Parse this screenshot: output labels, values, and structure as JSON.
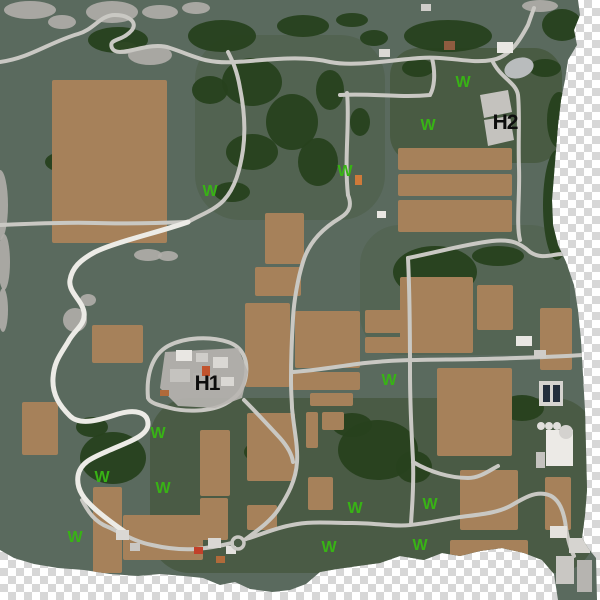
{
  "title": "farm-map-preview",
  "colors": {
    "checker_light": "#ffffff",
    "checker_dark": "#d7d7d7",
    "terrain": "#5a6a5e",
    "terrain_dark": "#46583e",
    "terrain_mid": "#4e5f4a",
    "forest": "#27411d",
    "field": "#a6815a",
    "road": "#c9c8c3",
    "road_white": "#ecebe6",
    "rock": "#b0aeaa",
    "water": "#b9bcbd",
    "pad": "#c4c2be",
    "platform": "#b8b5b1",
    "marker_green": "#38b315",
    "marker_black": "#0d0d0d"
  },
  "map": {
    "outline": "M0,0 L578,0 L580,15 L574,30 L577,45 L568,60 L565,80 L561,100 L558,125 L556,150 L554,175 L552,200 L553,225 L558,245 L566,262 L574,285 L578,310 L581,340 L583,375 L585,410 L586,450 L587,490 L585,515 L582,538 L588,548 L596,558 L597,600 L558,600 L554,574 L542,560 L524,553 L502,548 L480,551 L460,556 L442,553 L424,560 L400,556 L380,563 L358,566 L337,569 L320,572 L306,584 L290,590 L272,592 L250,589 L235,582 L220,585 L203,578 L184,576 L160,574 L138,576 L110,574 L84,570 L58,568 L34,564 L14,558 L0,550 Z",
    "regions": [
      {
        "x": 390,
        "y": 48,
        "w": 172,
        "h": 115,
        "rx": 28,
        "fill": "terrain_dark",
        "opacity": 0.85
      },
      {
        "x": 150,
        "y": 398,
        "w": 445,
        "h": 175,
        "rx": 40,
        "fill": "terrain_dark",
        "opacity": 0.8
      },
      {
        "x": 195,
        "y": 35,
        "w": 190,
        "h": 185,
        "rx": 45,
        "fill": "terrain_mid",
        "opacity": 0.65
      },
      {
        "x": 360,
        "y": 225,
        "w": 210,
        "h": 130,
        "rx": 40,
        "fill": "terrain_mid",
        "opacity": 0.5
      }
    ],
    "rocks": [
      [
        30,
        10,
        26,
        9
      ],
      [
        112,
        12,
        26,
        11
      ],
      [
        62,
        22,
        14,
        7
      ],
      [
        160,
        12,
        18,
        7
      ],
      [
        196,
        8,
        14,
        6
      ],
      [
        540,
        6,
        18,
        6
      ],
      [
        0,
        205,
        8,
        35
      ],
      [
        4,
        262,
        6,
        28
      ],
      [
        3,
        310,
        5,
        22
      ],
      [
        148,
        255,
        14,
        6
      ],
      [
        168,
        256,
        10,
        5
      ],
      [
        75,
        320,
        12,
        12
      ],
      [
        88,
        300,
        8,
        6
      ],
      [
        150,
        55,
        22,
        10
      ],
      [
        125,
        48,
        12,
        6
      ]
    ],
    "forests": [
      [
        118,
        40,
        30,
        13
      ],
      [
        222,
        36,
        34,
        16
      ],
      [
        303,
        26,
        26,
        11
      ],
      [
        352,
        20,
        16,
        7
      ],
      [
        448,
        36,
        44,
        16
      ],
      [
        562,
        25,
        20,
        16
      ],
      [
        95,
        150,
        36,
        20
      ],
      [
        63,
        162,
        18,
        10
      ],
      [
        210,
        90,
        18,
        14
      ],
      [
        252,
        82,
        30,
        24
      ],
      [
        292,
        122,
        26,
        28
      ],
      [
        252,
        152,
        26,
        18
      ],
      [
        318,
        162,
        20,
        24
      ],
      [
        232,
        192,
        18,
        10
      ],
      [
        374,
        38,
        14,
        8
      ],
      [
        418,
        68,
        16,
        9
      ],
      [
        330,
        90,
        14,
        20
      ],
      [
        360,
        122,
        10,
        14
      ],
      [
        150,
        178,
        16,
        8
      ],
      [
        95,
        147,
        12,
        34
      ],
      [
        435,
        272,
        42,
        26
      ],
      [
        498,
        256,
        26,
        10
      ],
      [
        557,
        205,
        14,
        55
      ],
      [
        559,
        120,
        12,
        28
      ],
      [
        545,
        68,
        16,
        9
      ],
      [
        378,
        450,
        40,
        30
      ],
      [
        352,
        425,
        20,
        12
      ],
      [
        414,
        467,
        18,
        16
      ],
      [
        270,
        452,
        26,
        13
      ],
      [
        113,
        458,
        33,
        26
      ],
      [
        92,
        427,
        16,
        10
      ],
      [
        522,
        408,
        22,
        13
      ],
      [
        474,
        561,
        18,
        7
      ]
    ],
    "fields": [
      [
        52,
        80,
        115,
        163
      ],
      [
        92,
        325,
        51,
        38
      ],
      [
        22,
        402,
        36,
        53
      ],
      [
        93,
        487,
        29,
        86
      ],
      [
        123,
        515,
        80,
        45
      ],
      [
        200,
        430,
        30,
        66
      ],
      [
        200,
        498,
        28,
        42
      ],
      [
        247,
        505,
        30,
        25
      ],
      [
        265,
        213,
        39,
        51
      ],
      [
        255,
        267,
        46,
        29
      ],
      [
        245,
        303,
        45,
        84
      ],
      [
        295,
        311,
        65,
        57
      ],
      [
        292,
        372,
        68,
        18
      ],
      [
        310,
        393,
        43,
        13
      ],
      [
        365,
        310,
        70,
        23
      ],
      [
        365,
        337,
        70,
        16
      ],
      [
        398,
        148,
        114,
        22
      ],
      [
        398,
        174,
        114,
        22
      ],
      [
        398,
        200,
        114,
        32
      ],
      [
        400,
        277,
        73,
        76
      ],
      [
        477,
        285,
        36,
        45
      ],
      [
        540,
        308,
        32,
        62
      ],
      [
        437,
        368,
        75,
        88
      ],
      [
        460,
        470,
        58,
        60
      ],
      [
        545,
        477,
        26,
        53
      ],
      [
        450,
        540,
        78,
        24
      ],
      [
        247,
        413,
        48,
        68
      ],
      [
        306,
        412,
        12,
        36
      ],
      [
        322,
        412,
        22,
        18
      ],
      [
        308,
        477,
        25,
        33
      ]
    ],
    "roads": [
      "M0,62 C30,58 50,42 78,34 C95,29 100,15 115,15 C128,15 138,22 132,30 C122,42 108,38 112,48 C118,60 148,40 170,48 C195,56 205,64 235,62 C270,60 300,55 330,62 C355,67 390,60 420,58 C450,56 470,64 492,60 C510,57 520,40 528,25 L534,8",
      "M347,93 C350,120 344,160 348,195",
      "M432,58 C436,75 434,88 430,95 C400,98 370,93 340,95",
      "M492,60 C500,78 516,82 518,95 C520,115 518,140 519,168 C520,195 516,225 520,240",
      "M408,258 C438,252 466,244 492,241 C512,239 520,243 530,252 C542,260 552,254 562,254",
      "M348,195 C352,205 350,212 340,218 C320,230 308,245 303,262 C298,278 294,300 293,318 C292,335 291,360 291,380 C291,395 292,402 292,408 C294,430 298,445 297,462 C296,480 288,495 278,510 C270,522 255,532 246,539",
      "M293,372 C320,370 340,366 365,363 C400,359 440,360 480,359 C520,358 555,357 583,355",
      "M408,258 C410,300 410,340 410,372 C410,410 412,440 413,460 C414,490 412,505 411,524",
      "M413,462 C430,472 450,478 468,478 C480,478 490,470 498,466",
      "M246,539 C260,535 275,528 292,525 C310,521 330,523 352,523 C375,523 395,527 410,525 C430,523 450,518 468,516 C485,514 500,512 512,505 C524,498 534,492 545,494 C558,496 564,510 566,528 C568,540 570,548 574,556",
      "M232,543 C220,546 208,548 196,549 C180,550 165,548 152,545 C135,542 120,532 108,527 C95,522 88,512 82,500",
      "M148,398 C146,375 152,355 168,346 C185,337 210,336 228,342 C243,347 248,360 246,375 C244,390 236,398 225,404 C210,412 185,412 170,408 C158,405 150,403 148,398 Z",
      "M244,400 C256,412 268,425 280,438 C288,447 292,455 293,462",
      "M188,222 C200,215 215,210 224,200 C235,188 240,170 243,150 C246,128 244,108 240,88 C237,70 232,60 228,52",
      "M0,225 C30,224 60,222 95,223 C130,224 160,223 188,222"
    ],
    "white_roads": [
      "M188,222 C160,232 115,242 95,252 C80,260 72,268 70,280 C68,292 82,300 84,312 C86,325 74,330 68,342 C60,355 54,362 53,378 C52,395 60,406 70,416 C80,426 100,420 118,414 C135,409 148,412 148,424 C148,436 128,442 110,450 C94,457 80,462 78,476 C76,490 85,500 95,509 C105,518 115,525 125,532"
    ],
    "pads": [
      "480,95 508,90 512,112 484,118",
      "484,120 510,116 514,140 488,146"
    ],
    "platform": "165,352 238,348 248,372 242,398 215,408 178,406 160,388",
    "water": {
      "cx": 519,
      "cy": 68,
      "rx": 15,
      "ry": 10,
      "rotate": -18
    },
    "buildings": [
      [
        176,
        350,
        16,
        11,
        "#e9e7e3"
      ],
      [
        196,
        353,
        12,
        9,
        "#cfcdc9"
      ],
      [
        213,
        357,
        15,
        11,
        "#dad8d4"
      ],
      [
        170,
        369,
        20,
        13,
        "#c5c3bf"
      ],
      [
        193,
        373,
        22,
        15,
        "#b2b0ac"
      ],
      [
        221,
        377,
        13,
        9,
        "#dad8d4"
      ],
      [
        202,
        366,
        8,
        10,
        "#c2542e"
      ],
      [
        160,
        390,
        9,
        6,
        "#b06a3a"
      ],
      [
        497,
        42,
        16,
        11,
        "#e9e7e3"
      ],
      [
        379,
        49,
        11,
        8,
        "#dad8d4"
      ],
      [
        444,
        41,
        11,
        9,
        "#8f5c40"
      ],
      [
        516,
        336,
        16,
        10,
        "#e9e7e3"
      ],
      [
        534,
        350,
        12,
        8,
        "#cfcdc9"
      ],
      [
        539,
        381,
        24,
        25,
        "#d6d4d0"
      ],
      [
        543,
        385,
        7,
        17,
        "#232e3c"
      ],
      [
        553,
        385,
        7,
        17,
        "#232e3c"
      ],
      [
        546,
        430,
        27,
        36,
        "#eceae6"
      ],
      [
        536,
        452,
        9,
        16,
        "#c5c3bf"
      ],
      [
        550,
        526,
        17,
        12,
        "#e4e2de"
      ],
      [
        569,
        538,
        21,
        15,
        "#d6d4d0"
      ],
      [
        556,
        556,
        18,
        28,
        "#c9c7c3"
      ],
      [
        577,
        560,
        15,
        32,
        "#b6b4b0"
      ],
      [
        208,
        538,
        13,
        10,
        "#dad8d4"
      ],
      [
        194,
        547,
        9,
        7,
        "#c2402a"
      ],
      [
        216,
        556,
        9,
        7,
        "#b06a3a"
      ],
      [
        226,
        546,
        10,
        8,
        "#e4e2de"
      ],
      [
        116,
        530,
        13,
        10,
        "#dad8d4"
      ],
      [
        130,
        543,
        10,
        8,
        "#c9c7c3"
      ],
      [
        377,
        211,
        9,
        7,
        "#e9e7e3"
      ],
      [
        355,
        175,
        7,
        10,
        "#cf7a3a"
      ],
      [
        421,
        4,
        10,
        7,
        "#cfcdc9"
      ]
    ],
    "silos": [
      [
        541,
        426,
        4,
        "#e0dedb"
      ],
      [
        549,
        426,
        4,
        "#e0dedb"
      ],
      [
        557,
        426,
        4,
        "#e0dedb"
      ],
      [
        566,
        432,
        7,
        "#d4d2cf"
      ]
    ],
    "roundabout": {
      "cx": 238,
      "cy": 543,
      "r": 6
    }
  },
  "labels": {
    "hotspots": [
      {
        "text": "H1",
        "x": 207,
        "y": 390,
        "size": 21
      },
      {
        "text": "H2",
        "x": 505,
        "y": 129,
        "size": 21
      }
    ],
    "w_markers": [
      {
        "text": "W",
        "x": 463,
        "y": 87
      },
      {
        "text": "W",
        "x": 428,
        "y": 130
      },
      {
        "text": "W",
        "x": 345,
        "y": 176
      },
      {
        "text": "W",
        "x": 210,
        "y": 196
      },
      {
        "text": "W",
        "x": 389,
        "y": 385
      },
      {
        "text": "W",
        "x": 158,
        "y": 438
      },
      {
        "text": "W",
        "x": 102,
        "y": 482
      },
      {
        "text": "W",
        "x": 163,
        "y": 493
      },
      {
        "text": "W",
        "x": 75,
        "y": 542
      },
      {
        "text": "W",
        "x": 355,
        "y": 513
      },
      {
        "text": "W",
        "x": 329,
        "y": 552
      },
      {
        "text": "W",
        "x": 430,
        "y": 509
      },
      {
        "text": "W",
        "x": 420,
        "y": 550
      }
    ]
  }
}
